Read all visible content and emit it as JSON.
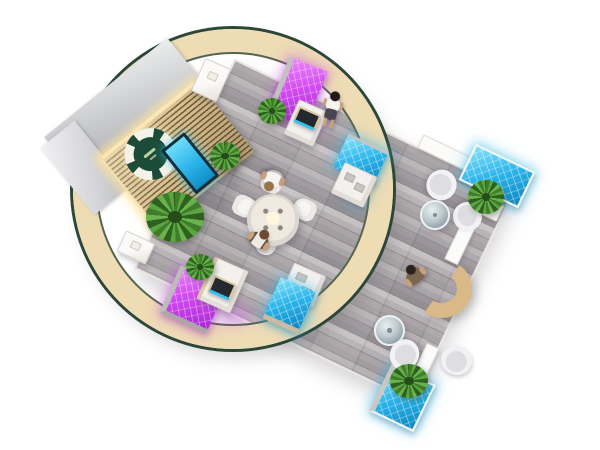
{
  "scene": {
    "description": "Top-down 3D rendering of an island trade-show booth with circular canopy ring",
    "view": "top-down",
    "background": "#ffffff"
  },
  "colors": {
    "cream": "#eedcb5",
    "green-dark": "#2c4737",
    "magenta": "#d24af0",
    "cyan": "#2ab4ea",
    "wood-slat": "#d9bf90",
    "wood-groove": "#6e5c38",
    "logo-green": "#1d4b39",
    "desk-tan": "#d9b988",
    "glow-warm": "#ffe9b8",
    "floor-plank": "#a29da0"
  },
  "structures": {
    "canopy_ring": {
      "shape": "circular band",
      "top": "cream",
      "trim": "dark green"
    },
    "logo_wall": {
      "material": "wood slats with warm accent lighting",
      "logo": "round dark-green emblem with white petal ring",
      "screen": "portrait display, cyan",
      "back": "gray enclosure walls"
    },
    "floor": {
      "shape": "rotated rectangle platform",
      "material": "gray wood planks"
    }
  },
  "kiosks": [
    {
      "id": "north",
      "panel": "magenta",
      "counter": true,
      "device": "laptop",
      "plant": true
    },
    {
      "id": "center",
      "panel": "cyan",
      "counter": true,
      "shelf_items": 2
    },
    {
      "id": "southwest",
      "panel": "magenta",
      "counter": true,
      "device": "laptop",
      "plant": true
    },
    {
      "id": "south",
      "panel": "cyan",
      "counter": true,
      "shelf_items": 2
    }
  ],
  "lightboxes": [
    {
      "id": "east-corner",
      "color": "cyan"
    },
    {
      "id": "south-corner",
      "color": "cyan"
    }
  ],
  "furniture": {
    "meeting_table": {
      "shape": "round",
      "seats": 4,
      "occupied": 2
    },
    "lounge_east": {
      "armchairs": 2,
      "coffee_table": "round glass",
      "plant": true
    },
    "lounge_south": {
      "armchairs": 2,
      "coffee_table": "round glass",
      "divider": true,
      "plant": true
    },
    "reception_desk": {
      "shape": "curved crescent",
      "occupied": true
    },
    "pedestals": 2
  },
  "people": [
    {
      "id": "visitor-walking",
      "pose": "standing",
      "hair": "dark",
      "top": "white",
      "bottom": "dark skirt"
    },
    {
      "id": "guest-north",
      "pose": "seated at round table",
      "top": "white"
    },
    {
      "id": "guest-south",
      "pose": "seated at round table",
      "top": "white with dark trim"
    },
    {
      "id": "staff-desk",
      "pose": "seated at reception desk",
      "top": "olive"
    }
  ],
  "plants": {
    "count": 6
  }
}
